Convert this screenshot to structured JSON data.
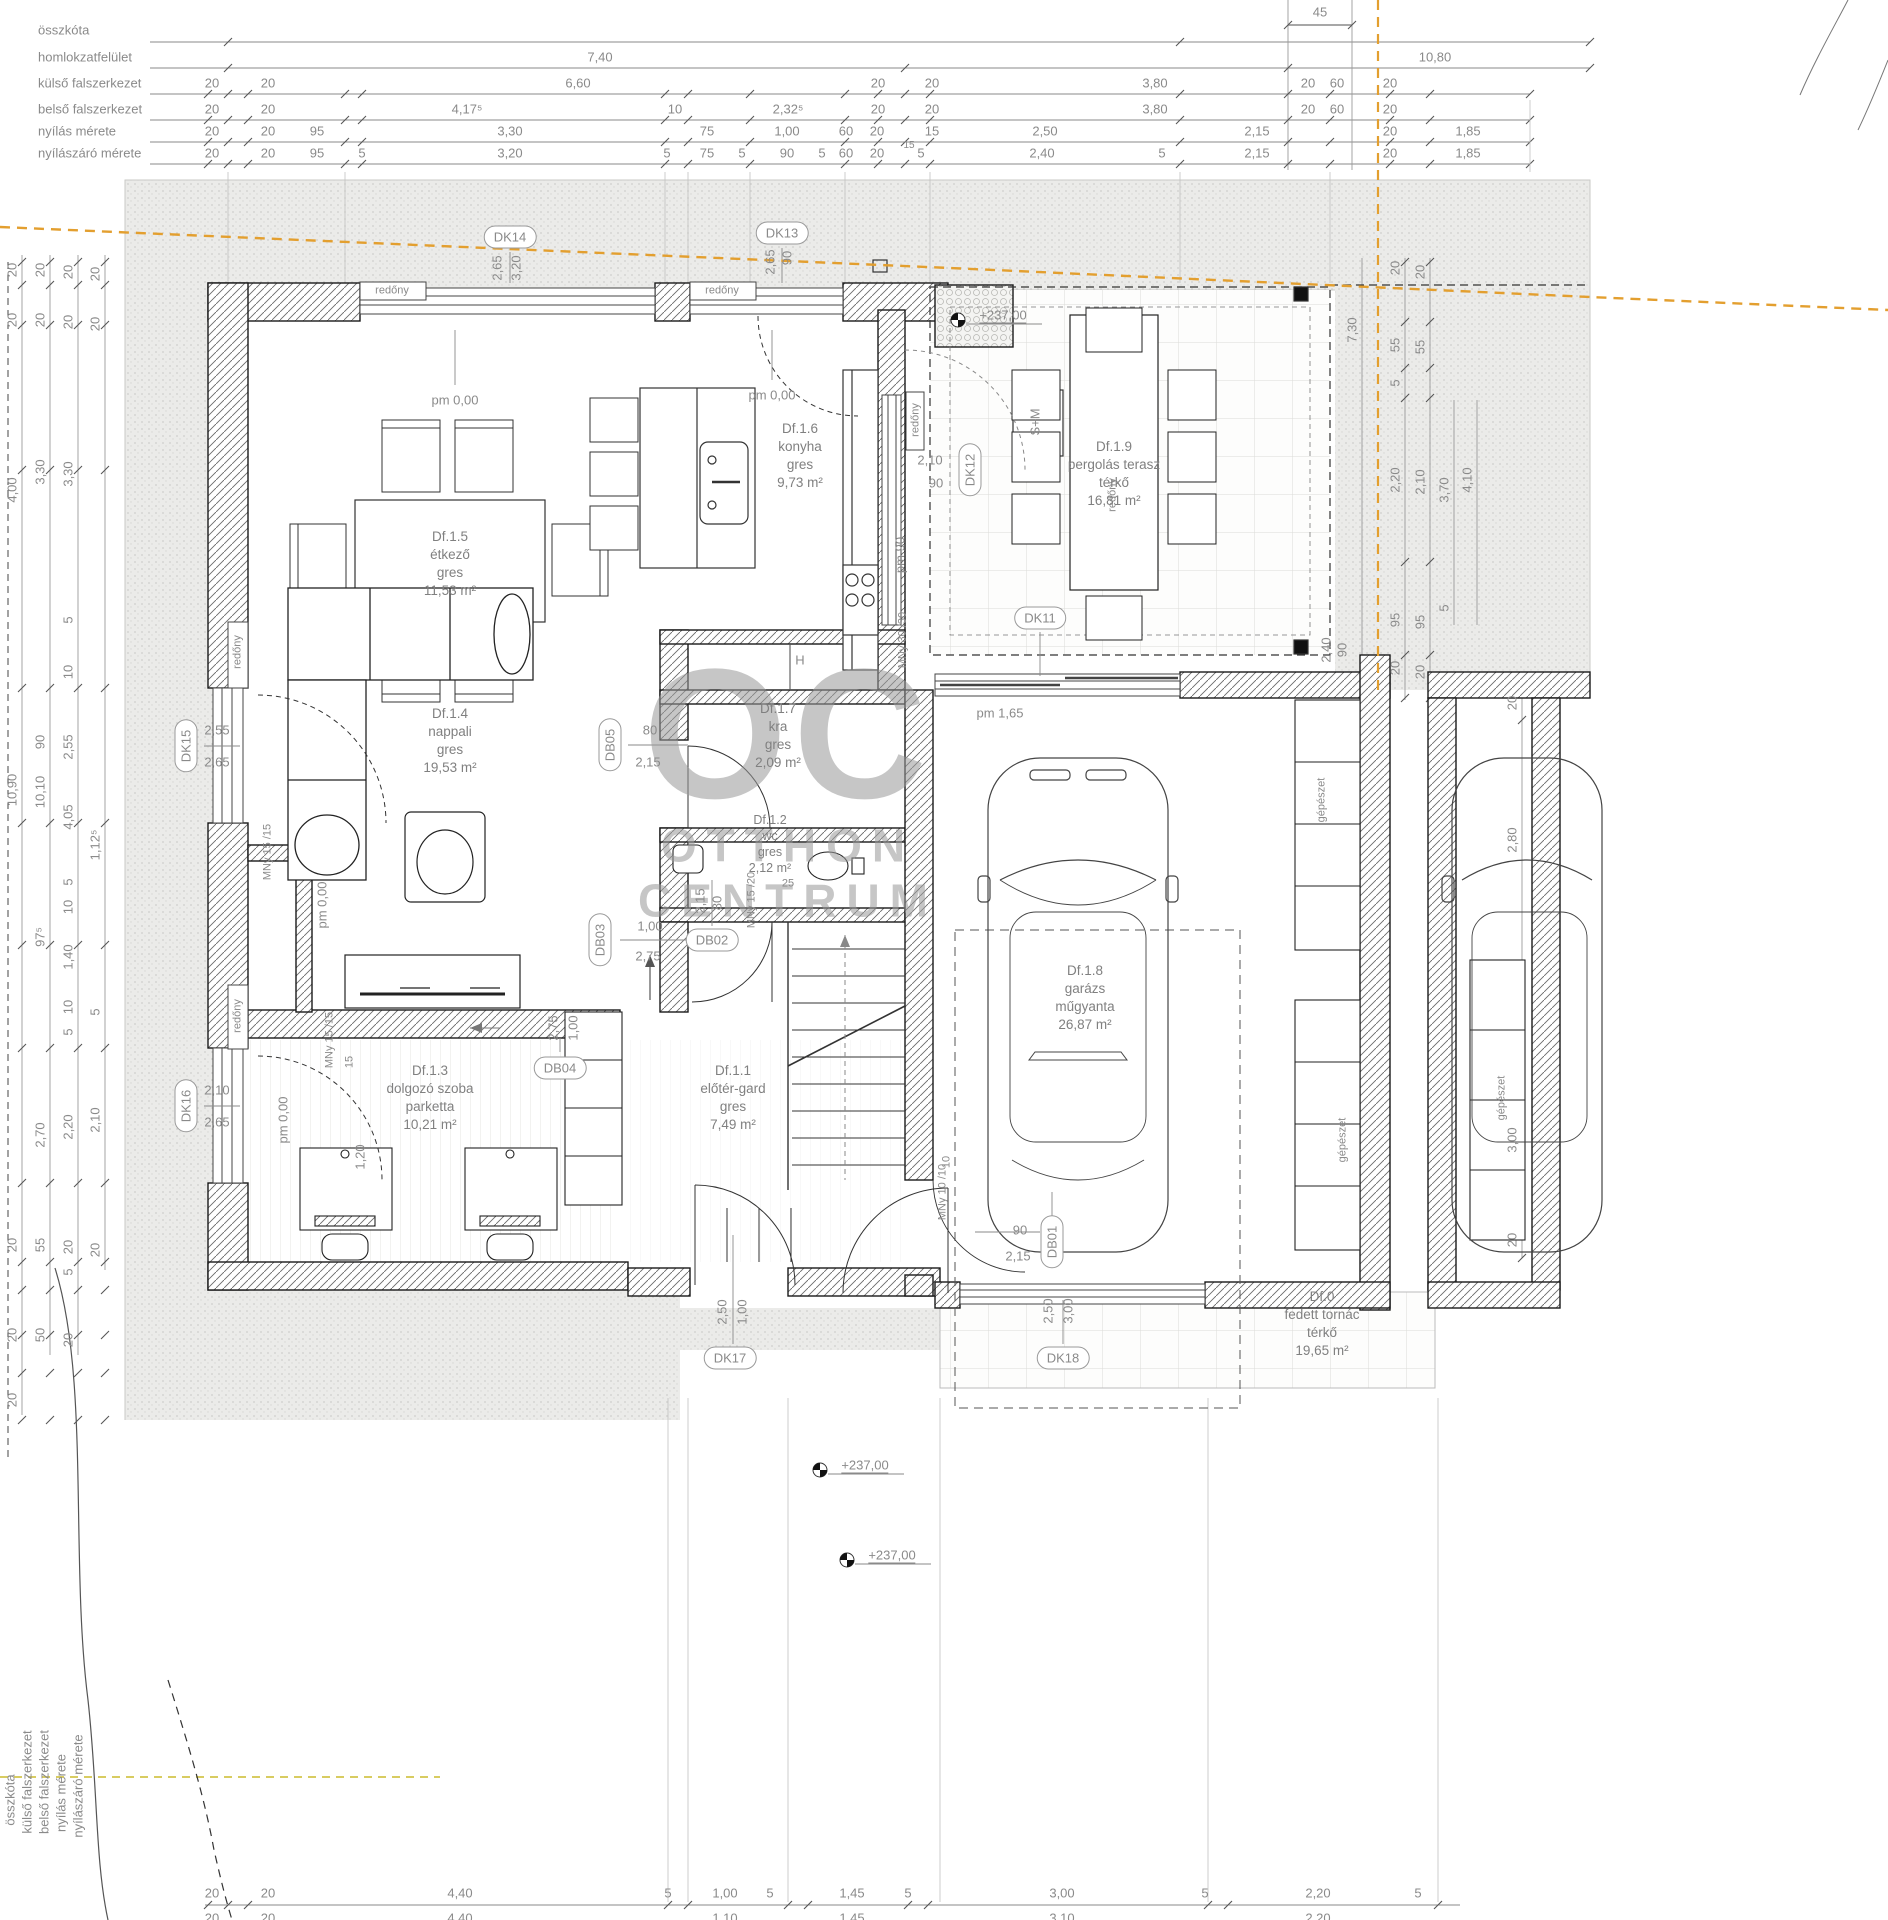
{
  "watermark": {
    "big": "OC",
    "line1": "OTTHON",
    "line2": "CENTRUM"
  },
  "rooms": [
    {
      "id": "Df.1.5",
      "lines": [
        "Df.1.5",
        "étkező",
        "gres",
        "11,53 m²"
      ],
      "x": 450,
      "y": 528
    },
    {
      "id": "Df.1.6",
      "lines": [
        "Df.1.6",
        "konyha",
        "gres",
        "9,73 m²"
      ],
      "x": 800,
      "y": 420
    },
    {
      "id": "Df.1.9",
      "lines": [
        "Df.1.9",
        "pergolás terasz",
        "térkő",
        "16,81 m²"
      ],
      "x": 1114,
      "y": 438
    },
    {
      "id": "Df.1.4",
      "lines": [
        "Df.1.4",
        "nappali",
        "gres",
        "19,53 m²"
      ],
      "x": 450,
      "y": 705
    },
    {
      "id": "Df.1.7",
      "lines": [
        "Df.1.7",
        "kra",
        "gres",
        "2,09 m²"
      ],
      "x": 778,
      "y": 700
    },
    {
      "id": "Df.1.2",
      "lines": [
        "Df.1.2",
        "wc",
        "gres",
        "2,12 m²"
      ],
      "x": 770,
      "y": 812,
      "small": true
    },
    {
      "id": "Df.1.3",
      "lines": [
        "Df.1.3",
        "dolgozó szoba",
        "parketta",
        "10,21 m²"
      ],
      "x": 430,
      "y": 1062
    },
    {
      "id": "Df.1.1",
      "lines": [
        "Df.1.1",
        "előtér-gard",
        "gres",
        "7,49 m²"
      ],
      "x": 733,
      "y": 1062
    },
    {
      "id": "Df.1.8",
      "lines": [
        "Df.1.8",
        "garázs",
        "műgyanta",
        "26,87 m²"
      ],
      "x": 1085,
      "y": 962
    },
    {
      "id": "Df.0",
      "lines": [
        "Df.0",
        "fedett tornác",
        "térkő",
        "19,65 m²"
      ],
      "x": 1322,
      "y": 1288
    }
  ],
  "bubbles": [
    {
      "t": "DK14",
      "x": 510,
      "y": 237,
      "r": 0
    },
    {
      "t": "DK13",
      "x": 782,
      "y": 233,
      "r": 0
    },
    {
      "t": "DK12",
      "x": 970,
      "y": 470,
      "r": 1
    },
    {
      "t": "DK11",
      "x": 1040,
      "y": 618,
      "r": 0
    },
    {
      "t": "DK15",
      "x": 186,
      "y": 746,
      "r": 1
    },
    {
      "t": "DK16",
      "x": 186,
      "y": 1106,
      "r": 1
    },
    {
      "t": "DK17",
      "x": 730,
      "y": 1358,
      "r": 0
    },
    {
      "t": "DK18",
      "x": 1063,
      "y": 1358,
      "r": 0
    },
    {
      "t": "DB05",
      "x": 610,
      "y": 745,
      "r": 1
    },
    {
      "t": "DB03",
      "x": 600,
      "y": 940,
      "r": 1
    },
    {
      "t": "DB02",
      "x": 712,
      "y": 940,
      "r": 0
    },
    {
      "t": "DB04",
      "x": 560,
      "y": 1068,
      "r": 0
    },
    {
      "t": "DB01",
      "x": 1052,
      "y": 1242,
      "r": 1
    }
  ],
  "labels": [
    {
      "t": "összkóta",
      "x": 38,
      "y": 30,
      "a": "left"
    },
    {
      "t": "homlokzatfelület",
      "x": 38,
      "y": 57,
      "a": "left"
    },
    {
      "t": "külső falszerkezet",
      "x": 38,
      "y": 83,
      "a": "left"
    },
    {
      "t": "belső falszerkezet",
      "x": 38,
      "y": 109,
      "a": "left"
    },
    {
      "t": "nyílás mérete",
      "x": 38,
      "y": 131,
      "a": "left"
    },
    {
      "t": "nyílászáró mérete",
      "x": 38,
      "y": 153,
      "a": "left"
    },
    {
      "t": "45",
      "x": 1320,
      "y": 12
    },
    {
      "t": "7,40",
      "x": 600,
      "y": 57
    },
    {
      "t": "10,80",
      "x": 1435,
      "y": 57
    },
    {
      "t": "20",
      "x": 212,
      "y": 83
    },
    {
      "t": "20",
      "x": 268,
      "y": 83
    },
    {
      "t": "6,60",
      "x": 578,
      "y": 83
    },
    {
      "t": "20",
      "x": 878,
      "y": 83
    },
    {
      "t": "20",
      "x": 932,
      "y": 83
    },
    {
      "t": "3,80",
      "x": 1155,
      "y": 83
    },
    {
      "t": "20",
      "x": 1308,
      "y": 83
    },
    {
      "t": "60",
      "x": 1337,
      "y": 83
    },
    {
      "t": "20",
      "x": 1390,
      "y": 83
    },
    {
      "t": "20",
      "x": 212,
      "y": 109
    },
    {
      "t": "20",
      "x": 268,
      "y": 109
    },
    {
      "t": "4,17⁵",
      "x": 467,
      "y": 109
    },
    {
      "t": "10",
      "x": 675,
      "y": 109
    },
    {
      "t": "2,32⁵",
      "x": 788,
      "y": 109
    },
    {
      "t": "20",
      "x": 878,
      "y": 109
    },
    {
      "t": "20",
      "x": 932,
      "y": 109
    },
    {
      "t": "3,80",
      "x": 1155,
      "y": 109
    },
    {
      "t": "20",
      "x": 1308,
      "y": 109
    },
    {
      "t": "60",
      "x": 1337,
      "y": 109
    },
    {
      "t": "20",
      "x": 1390,
      "y": 109
    },
    {
      "t": "20",
      "x": 212,
      "y": 131
    },
    {
      "t": "20",
      "x": 268,
      "y": 131
    },
    {
      "t": "95",
      "x": 317,
      "y": 131
    },
    {
      "t": "3,30",
      "x": 510,
      "y": 131
    },
    {
      "t": "75",
      "x": 707,
      "y": 131
    },
    {
      "t": "1,00",
      "x": 787,
      "y": 131
    },
    {
      "t": "60",
      "x": 846,
      "y": 131
    },
    {
      "t": "20",
      "x": 877,
      "y": 131
    },
    {
      "t": "15",
      "x": 932,
      "y": 131
    },
    {
      "t": "2,50",
      "x": 1045,
      "y": 131
    },
    {
      "t": "2,15",
      "x": 1257,
      "y": 131
    },
    {
      "t": "20",
      "x": 1390,
      "y": 131
    },
    {
      "t": "1,85",
      "x": 1468,
      "y": 131
    },
    {
      "t": "15",
      "x": 909,
      "y": 146,
      "s": 10
    },
    {
      "t": "20",
      "x": 212,
      "y": 153
    },
    {
      "t": "20",
      "x": 268,
      "y": 153
    },
    {
      "t": "95",
      "x": 317,
      "y": 153
    },
    {
      "t": "5",
      "x": 362,
      "y": 153
    },
    {
      "t": "3,20",
      "x": 510,
      "y": 153
    },
    {
      "t": "5",
      "x": 667,
      "y": 153
    },
    {
      "t": "75",
      "x": 707,
      "y": 153
    },
    {
      "t": "5",
      "x": 742,
      "y": 153
    },
    {
      "t": "90",
      "x": 787,
      "y": 153
    },
    {
      "t": "5",
      "x": 822,
      "y": 153
    },
    {
      "t": "60",
      "x": 846,
      "y": 153
    },
    {
      "t": "20",
      "x": 877,
      "y": 153
    },
    {
      "t": "5",
      "x": 921,
      "y": 153
    },
    {
      "t": "2,40",
      "x": 1042,
      "y": 153
    },
    {
      "t": "5",
      "x": 1162,
      "y": 153
    },
    {
      "t": "2,15",
      "x": 1257,
      "y": 153
    },
    {
      "t": "20",
      "x": 1390,
      "y": 153
    },
    {
      "t": "1,85",
      "x": 1468,
      "y": 153
    },
    {
      "t": "20",
      "x": 212,
      "y": 1893
    },
    {
      "t": "20",
      "x": 268,
      "y": 1893
    },
    {
      "t": "4,40",
      "x": 460,
      "y": 1893
    },
    {
      "t": "5",
      "x": 668,
      "y": 1893
    },
    {
      "t": "1,00",
      "x": 725,
      "y": 1893
    },
    {
      "t": "5",
      "x": 770,
      "y": 1893
    },
    {
      "t": "1,45",
      "x": 852,
      "y": 1893
    },
    {
      "t": "5",
      "x": 908,
      "y": 1893
    },
    {
      "t": "3,00",
      "x": 1062,
      "y": 1893
    },
    {
      "t": "5",
      "x": 1205,
      "y": 1893
    },
    {
      "t": "2,20",
      "x": 1318,
      "y": 1893
    },
    {
      "t": "5",
      "x": 1418,
      "y": 1893
    },
    {
      "t": "20",
      "x": 212,
      "y": 1918
    },
    {
      "t": "20",
      "x": 268,
      "y": 1918
    },
    {
      "t": "4,40",
      "x": 460,
      "y": 1918
    },
    {
      "t": "1,10",
      "x": 725,
      "y": 1918
    },
    {
      "t": "1,45",
      "x": 852,
      "y": 1918
    },
    {
      "t": "3,10",
      "x": 1062,
      "y": 1918
    },
    {
      "t": "2,20",
      "x": 1318,
      "y": 1918
    },
    {
      "t": "20",
      "x": 212,
      "y": 1943
    },
    {
      "t": "20",
      "x": 268,
      "y": 1943
    },
    {
      "t": "3,70",
      "x": 440,
      "y": 1943
    },
    {
      "t": "10",
      "x": 628,
      "y": 1943
    },
    {
      "t": "2,80",
      "x": 760,
      "y": 1943
    },
    {
      "t": "20",
      "x": 905,
      "y": 1943
    },
    {
      "t": "4,00",
      "x": 1100,
      "y": 1943
    },
    {
      "t": "20",
      "x": 1310,
      "y": 1943
    },
    {
      "t": "20",
      "x": 212,
      "y": 1968
    },
    {
      "t": "20",
      "x": 268,
      "y": 1968
    },
    {
      "t": "6,60",
      "x": 578,
      "y": 1968
    },
    {
      "t": "20",
      "x": 905,
      "y": 1968
    },
    {
      "t": "4,00",
      "x": 1100,
      "y": 1968
    },
    {
      "t": "20",
      "x": 1310,
      "y": 1968
    },
    {
      "t": "összkóta",
      "x": 10,
      "y": 1800,
      "r": 1
    },
    {
      "t": "külső falszerkezet",
      "x": 27,
      "y": 1782,
      "r": 1
    },
    {
      "t": "belső falszerkezet",
      "x": 44,
      "y": 1782,
      "r": 1
    },
    {
      "t": "nyílás mérete",
      "x": 61,
      "y": 1793,
      "r": 1
    },
    {
      "t": "nyílászáró mérete",
      "x": 78,
      "y": 1786,
      "r": 1
    },
    {
      "t": "20",
      "x": 12,
      "y": 270,
      "r": 1
    },
    {
      "t": "20",
      "x": 12,
      "y": 320,
      "r": 1
    },
    {
      "t": "4,00",
      "x": 12,
      "y": 490,
      "r": 1
    },
    {
      "t": "10,90",
      "x": 12,
      "y": 790,
      "r": 1
    },
    {
      "t": "20",
      "x": 12,
      "y": 1245,
      "r": 1
    },
    {
      "t": "20",
      "x": 12,
      "y": 1335,
      "r": 1
    },
    {
      "t": "20",
      "x": 12,
      "y": 1400,
      "r": 1
    },
    {
      "t": "20",
      "x": 40,
      "y": 270,
      "r": 1
    },
    {
      "t": "20",
      "x": 40,
      "y": 320,
      "r": 1
    },
    {
      "t": "3,30",
      "x": 40,
      "y": 472,
      "r": 1
    },
    {
      "t": "90",
      "x": 40,
      "y": 742,
      "r": 1
    },
    {
      "t": "10,10",
      "x": 40,
      "y": 792,
      "r": 1
    },
    {
      "t": "97⁵",
      "x": 40,
      "y": 937,
      "r": 1
    },
    {
      "t": "2,70",
      "x": 40,
      "y": 1135,
      "r": 1
    },
    {
      "t": "55",
      "x": 40,
      "y": 1245,
      "r": 1
    },
    {
      "t": "50",
      "x": 40,
      "y": 1335,
      "r": 1
    },
    {
      "t": "20",
      "x": 68,
      "y": 272,
      "r": 1
    },
    {
      "t": "20",
      "x": 68,
      "y": 322,
      "r": 1
    },
    {
      "t": "3,30",
      "x": 68,
      "y": 474,
      "r": 1
    },
    {
      "t": "5",
      "x": 68,
      "y": 620,
      "r": 1
    },
    {
      "t": "10",
      "x": 68,
      "y": 672,
      "r": 1
    },
    {
      "t": "2,55",
      "x": 68,
      "y": 747,
      "r": 1
    },
    {
      "t": "4,05",
      "x": 68,
      "y": 817,
      "r": 1
    },
    {
      "t": "5",
      "x": 68,
      "y": 882,
      "r": 1
    },
    {
      "t": "10",
      "x": 68,
      "y": 907,
      "r": 1
    },
    {
      "t": "1,40",
      "x": 68,
      "y": 957,
      "r": 1
    },
    {
      "t": "10",
      "x": 68,
      "y": 1007,
      "r": 1
    },
    {
      "t": "5",
      "x": 68,
      "y": 1032,
      "r": 1
    },
    {
      "t": "2,20",
      "x": 68,
      "y": 1127,
      "r": 1
    },
    {
      "t": "20",
      "x": 68,
      "y": 1247,
      "r": 1
    },
    {
      "t": "5",
      "x": 68,
      "y": 1272,
      "r": 1
    },
    {
      "t": "20",
      "x": 68,
      "y": 1340,
      "r": 1
    },
    {
      "t": "20",
      "x": 95,
      "y": 274,
      "r": 1
    },
    {
      "t": "20",
      "x": 95,
      "y": 324,
      "r": 1
    },
    {
      "t": "1,12⁵",
      "x": 95,
      "y": 845,
      "r": 1
    },
    {
      "t": "5",
      "x": 95,
      "y": 1012,
      "r": 1
    },
    {
      "t": "2,10",
      "x": 95,
      "y": 1120,
      "r": 1
    },
    {
      "t": "20",
      "x": 95,
      "y": 1250,
      "r": 1
    },
    {
      "t": "7,30",
      "x": 1352,
      "y": 330,
      "r": 1
    },
    {
      "t": "20",
      "x": 1395,
      "y": 268,
      "r": 1
    },
    {
      "t": "55",
      "x": 1395,
      "y": 345,
      "r": 1
    },
    {
      "t": "5",
      "x": 1395,
      "y": 383,
      "r": 1
    },
    {
      "t": "2,20",
      "x": 1395,
      "y": 480,
      "r": 1
    },
    {
      "t": "95",
      "x": 1395,
      "y": 620,
      "r": 1
    },
    {
      "t": "20",
      "x": 1395,
      "y": 668,
      "r": 1
    },
    {
      "t": "20",
      "x": 1420,
      "y": 272,
      "r": 1
    },
    {
      "t": "55",
      "x": 1420,
      "y": 347,
      "r": 1
    },
    {
      "t": "2,10",
      "x": 1420,
      "y": 482,
      "r": 1
    },
    {
      "t": "95",
      "x": 1420,
      "y": 622,
      "r": 1
    },
    {
      "t": "20",
      "x": 1420,
      "y": 672,
      "r": 1
    },
    {
      "t": "3,70",
      "x": 1444,
      "y": 490,
      "r": 1
    },
    {
      "t": "5",
      "x": 1444,
      "y": 608,
      "r": 1
    },
    {
      "t": "4,10",
      "x": 1467,
      "y": 480,
      "r": 1
    },
    {
      "t": "20",
      "x": 1512,
      "y": 703,
      "r": 1
    },
    {
      "t": "2,80",
      "x": 1512,
      "y": 840,
      "r": 1
    },
    {
      "t": "3,00",
      "x": 1512,
      "y": 1140,
      "r": 1
    },
    {
      "t": "20",
      "x": 1512,
      "y": 1240,
      "r": 1
    },
    {
      "t": "2,40",
      "x": 1326,
      "y": 650,
      "r": 1
    },
    {
      "t": "90",
      "x": 1342,
      "y": 650,
      "r": 1
    },
    {
      "t": "2,65",
      "x": 497,
      "y": 268,
      "r": 1
    },
    {
      "t": "3,20",
      "x": 516,
      "y": 268,
      "r": 1
    },
    {
      "t": "2,65",
      "x": 770,
      "y": 262,
      "r": 1
    },
    {
      "t": "90",
      "x": 787,
      "y": 258,
      "r": 1
    },
    {
      "t": "2,55",
      "x": 217,
      "y": 730
    },
    {
      "t": "2,65",
      "x": 217,
      "y": 762
    },
    {
      "t": "2,10",
      "x": 217,
      "y": 1090
    },
    {
      "t": "2,65",
      "x": 217,
      "y": 1122
    },
    {
      "t": "2,10",
      "x": 930,
      "y": 460
    },
    {
      "t": "90",
      "x": 936,
      "y": 483
    },
    {
      "t": "1,00",
      "x": 742,
      "y": 1312,
      "r": 1
    },
    {
      "t": "2,50",
      "x": 722,
      "y": 1312,
      "r": 1
    },
    {
      "t": "2,50",
      "x": 1048,
      "y": 1311,
      "r": 1
    },
    {
      "t": "3,00",
      "x": 1068,
      "y": 1311,
      "r": 1
    },
    {
      "t": "80",
      "x": 650,
      "y": 730
    },
    {
      "t": "2,15",
      "x": 648,
      "y": 762
    },
    {
      "t": "1,00",
      "x": 650,
      "y": 926
    },
    {
      "t": "2,75",
      "x": 648,
      "y": 956
    },
    {
      "t": "2,15",
      "x": 700,
      "y": 901,
      "r": 1
    },
    {
      "t": "80",
      "x": 717,
      "y": 903,
      "r": 1
    },
    {
      "t": "1,00",
      "x": 573,
      "y": 1028,
      "r": 1
    },
    {
      "t": "2,75",
      "x": 553,
      "y": 1028,
      "r": 1
    },
    {
      "t": "90",
      "x": 1020,
      "y": 1230
    },
    {
      "t": "2,15",
      "x": 1018,
      "y": 1256
    },
    {
      "t": "pm 0,00",
      "x": 455,
      "y": 400
    },
    {
      "t": "pm 0,00",
      "x": 772,
      "y": 395
    },
    {
      "t": "pm 0,00",
      "x": 322,
      "y": 905,
      "r": 1
    },
    {
      "t": "pm 0,00",
      "x": 283,
      "y": 1120,
      "r": 1
    },
    {
      "t": "pm 90",
      "x": 900,
      "y": 555,
      "r": 1
    },
    {
      "t": "pm 1,65",
      "x": 1000,
      "y": 713
    },
    {
      "t": "+237,00",
      "x": 1003,
      "y": 316,
      "u": 1
    },
    {
      "t": "+237,00",
      "x": 865,
      "y": 1466,
      "u": 1
    },
    {
      "t": "+237,00",
      "x": 892,
      "y": 1556,
      "u": 1
    },
    {
      "t": "S+M",
      "x": 1035,
      "y": 422,
      "r": 1
    },
    {
      "t": "redőny",
      "x": 392,
      "y": 291,
      "s": 11
    },
    {
      "t": "redőny",
      "x": 722,
      "y": 291,
      "s": 11
    },
    {
      "t": "redőny",
      "x": 238,
      "y": 652,
      "r": 1,
      "s": 11
    },
    {
      "t": "redőny",
      "x": 238,
      "y": 1016,
      "r": 1,
      "s": 11
    },
    {
      "t": "redőny",
      "x": 916,
      "y": 420,
      "r": 1,
      "s": 11
    },
    {
      "t": "redőny",
      "x": 1113,
      "y": 495,
      "r": 1,
      "s": 11
    },
    {
      "t": "MNy 30 /30",
      "x": 903,
      "y": 640,
      "r": 1,
      "s": 11
    },
    {
      "t": "MNy 15 /15",
      "x": 268,
      "y": 852,
      "r": 1,
      "s": 11
    },
    {
      "t": "MNy 15 /15",
      "x": 330,
      "y": 1040,
      "r": 1,
      "s": 11
    },
    {
      "t": "MNy 15 /20",
      "x": 752,
      "y": 900,
      "r": 1,
      "s": 11
    },
    {
      "t": "MNy 10 /10",
      "x": 943,
      "y": 1192,
      "r": 1,
      "s": 11
    },
    {
      "t": "15",
      "x": 350,
      "y": 1062,
      "r": 1,
      "s": 11
    },
    {
      "t": "1,20",
      "x": 360,
      "y": 1157,
      "r": 1
    },
    {
      "t": "10",
      "x": 947,
      "y": 1162,
      "r": 1,
      "s": 11
    },
    {
      "t": "H",
      "x": 800,
      "y": 660
    },
    {
      "t": "25",
      "x": 788,
      "y": 884,
      "s": 11
    },
    {
      "t": "gépészet",
      "x": 1322,
      "y": 800,
      "r": 1,
      "s": 11
    },
    {
      "t": "gépészet",
      "x": 1343,
      "y": 1140,
      "r": 1,
      "s": 11
    },
    {
      "t": "gépészet",
      "x": 1502,
      "y": 1098,
      "r": 1,
      "s": 11
    }
  ]
}
